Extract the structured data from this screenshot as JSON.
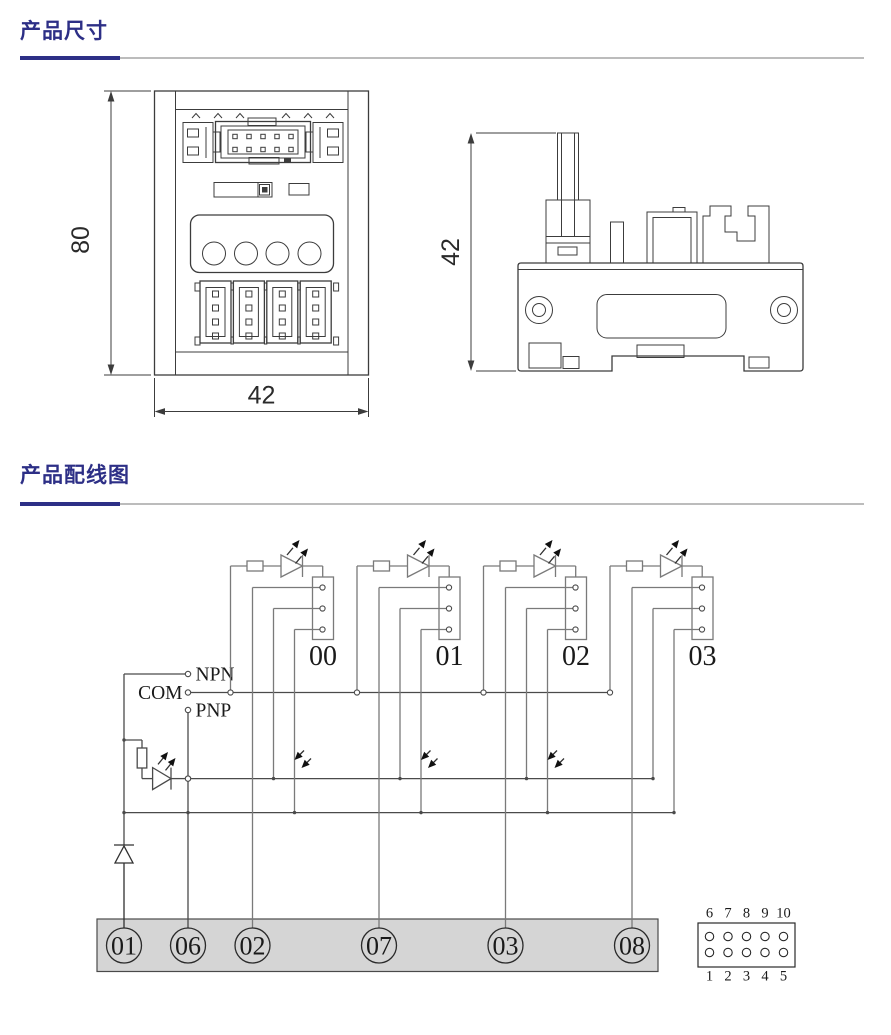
{
  "page": {
    "background": "#ffffff",
    "accent": "#2d2f86"
  },
  "sections": {
    "dimensions": {
      "title": "产品尺寸"
    },
    "wiring": {
      "title": "产品配线图"
    }
  },
  "dimension_drawing": {
    "front_view": {
      "height_label": "80",
      "width_label": "42"
    },
    "side_view": {
      "height_label": "42"
    }
  },
  "wiring_diagram": {
    "channel_labels": [
      "00",
      "01",
      "02",
      "03"
    ],
    "input_terminals": {
      "npn": "NPN",
      "com": "COM",
      "pnp": "PNP"
    },
    "strip_terminals": [
      "01",
      "06",
      "02",
      "07",
      "03",
      "08"
    ],
    "idc_connector": {
      "top_row": [
        "6",
        "7",
        "8",
        "9",
        "10"
      ],
      "bottom_row": [
        "1",
        "2",
        "3",
        "4",
        "5"
      ]
    }
  }
}
